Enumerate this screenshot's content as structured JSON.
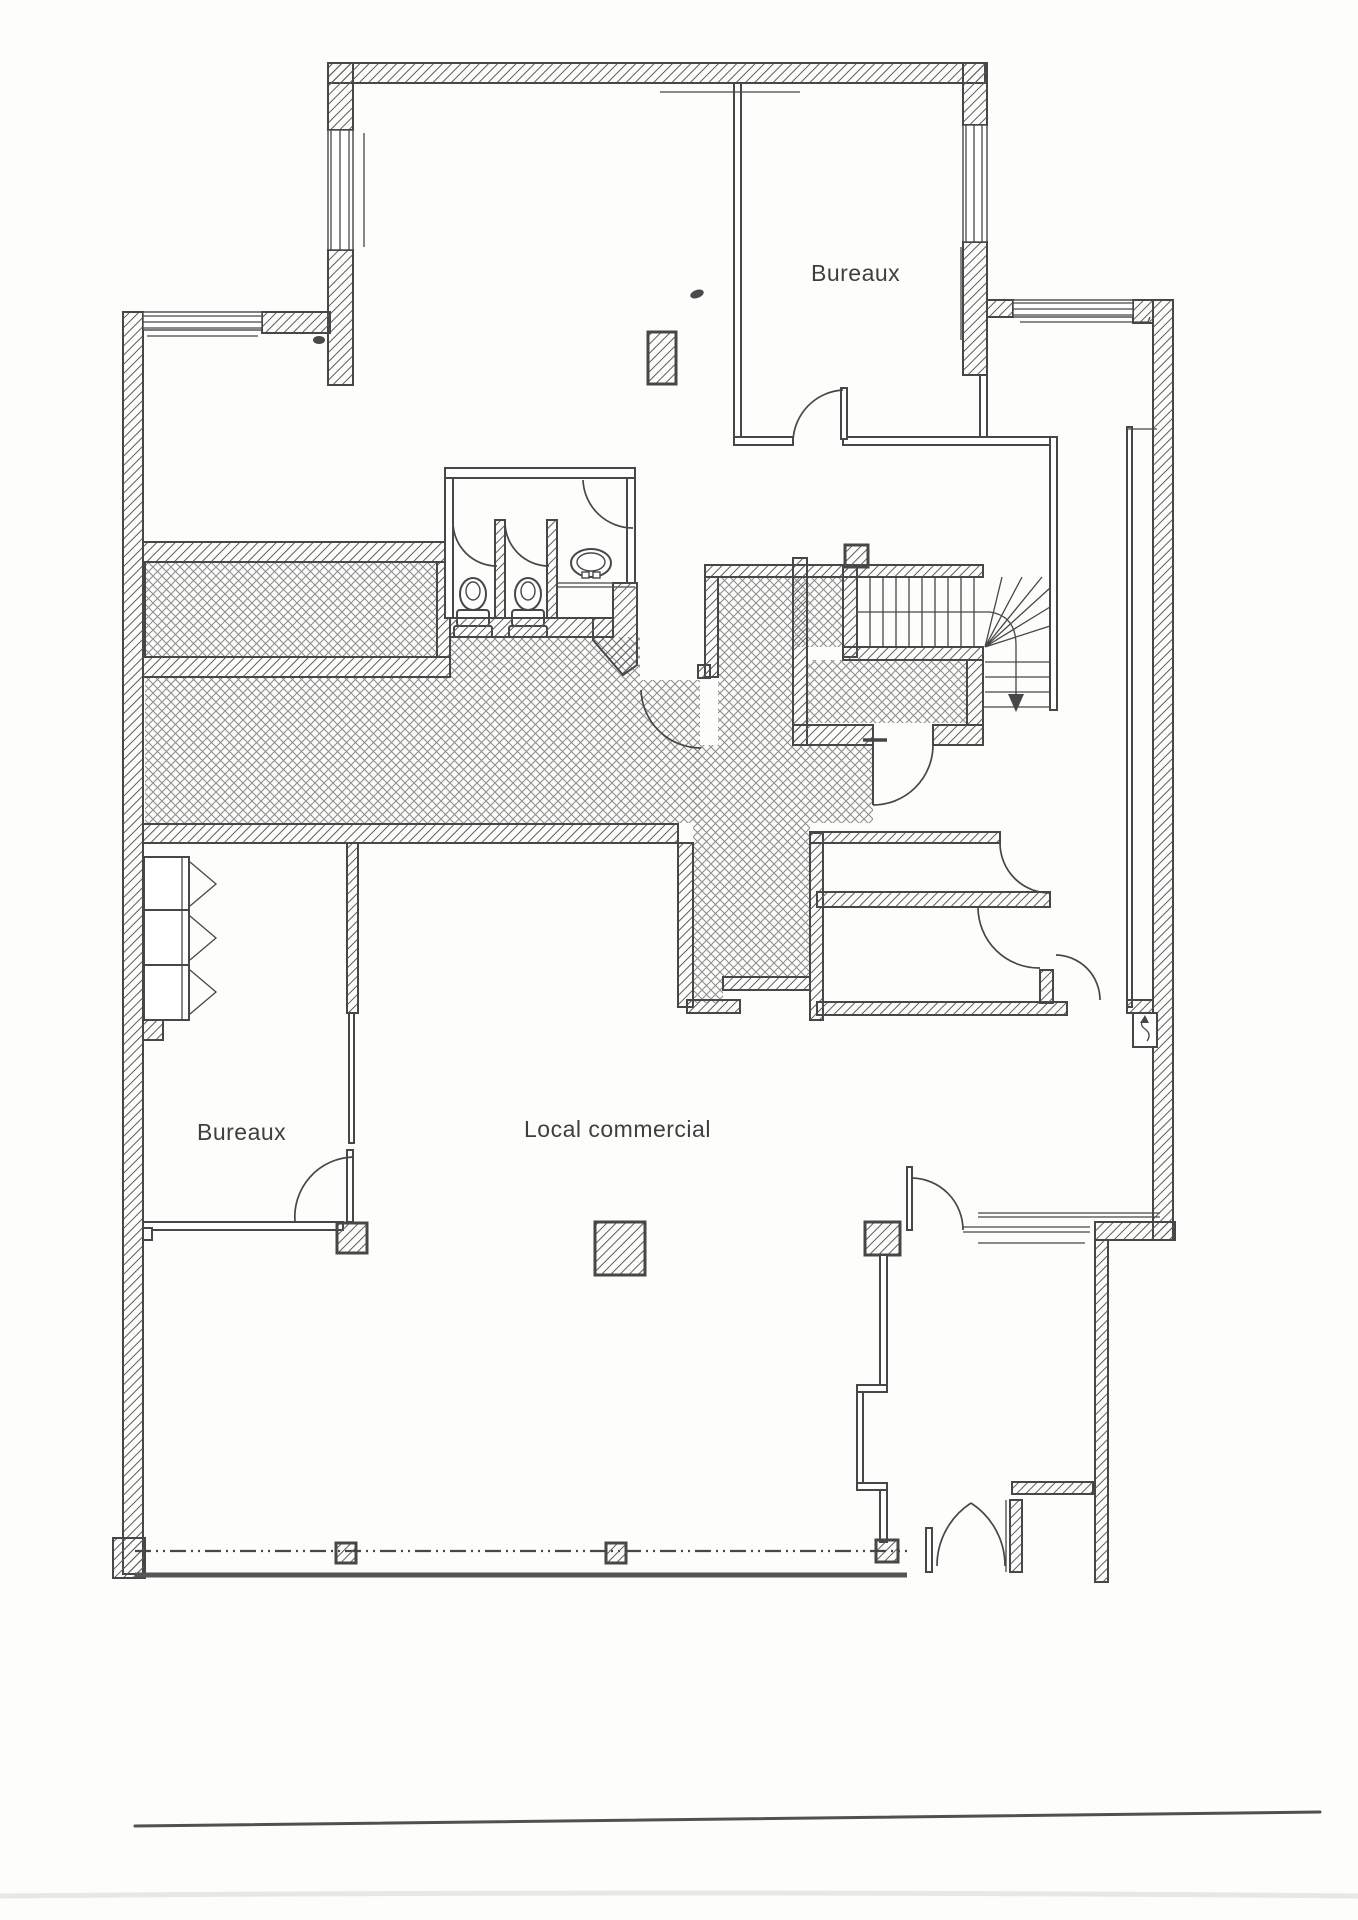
{
  "document": {
    "kind": "architectural floor plan (scanned, black and white)",
    "language": "fr"
  },
  "labels": {
    "office_top": "Bureaux",
    "office_bottom": "Bureaux",
    "commercial": "Local commercial"
  },
  "colors": {
    "paper": "#fdfdfb",
    "ink": "#474747",
    "wall_hatch": "#5c5c5c",
    "floor_hatch": "#8e8e8e"
  },
  "symbols": {
    "wc_count": 2,
    "washbasin_count": 1,
    "staircase": "winder stair with down arrow",
    "storefront": "dash-dot glazing line with mullion posts"
  }
}
